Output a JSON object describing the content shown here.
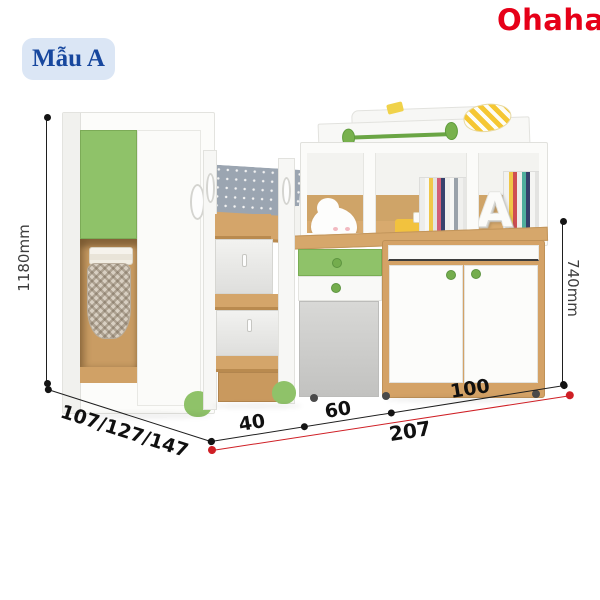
{
  "badge": {
    "label": "Mẫu A"
  },
  "logo": {
    "text": "Ohaha",
    "registered": "®"
  },
  "dimensions": {
    "height": "1180mm",
    "right_height": "740mm",
    "depth_options": "107/127/147",
    "width_segments": [
      "40",
      "60",
      "100"
    ],
    "total_width": "207"
  },
  "shelf": {
    "decor_letter": "A"
  },
  "colors": {
    "logo_red": "#e60018",
    "badge_bg": "#dbe6f5",
    "badge_text": "#17479e",
    "accent_green": "#8fc269",
    "knob_green": "#74ad4d",
    "wood": "#d4a56a",
    "dimension_line_black": "#1f1f1f",
    "dimension_line_red": "#cf1f25"
  }
}
